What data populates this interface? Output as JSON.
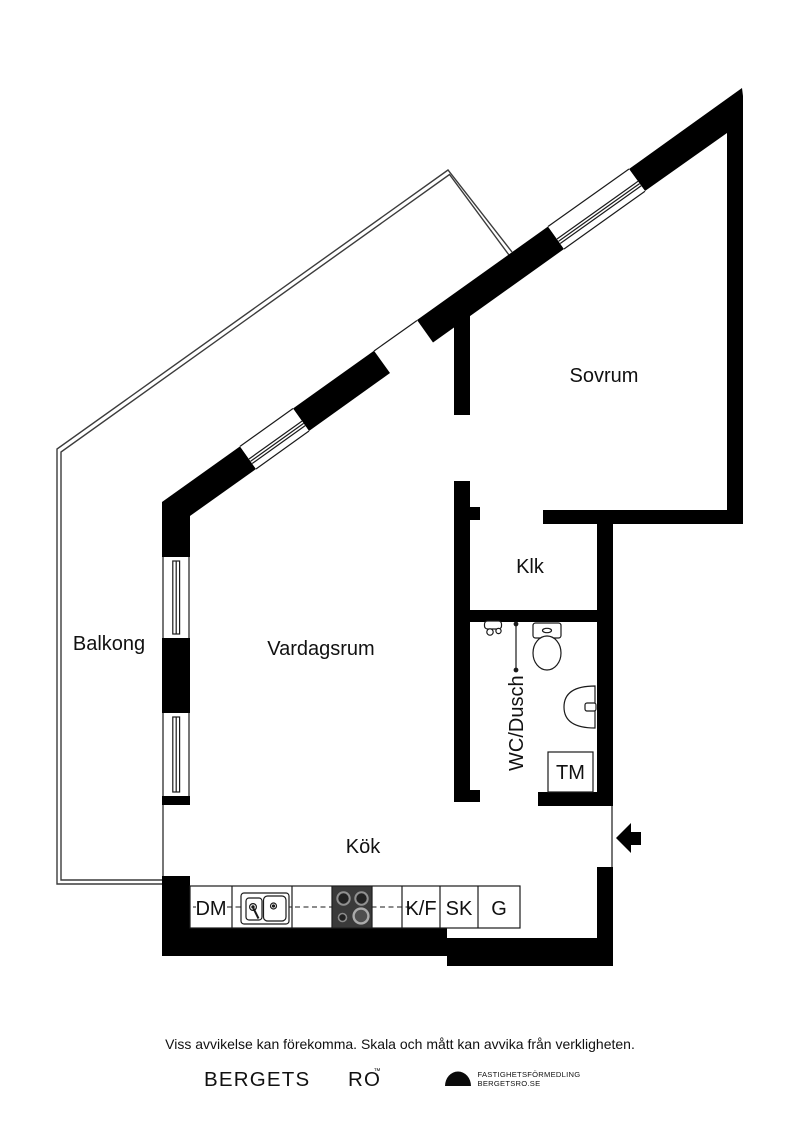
{
  "plan": {
    "rooms": {
      "sovrum": "Sovrum",
      "klk": "Klk",
      "vardagsrum": "Vardagsrum",
      "balkong": "Balkong",
      "kok": "Kök",
      "wc_dusch": "WC/Dusch",
      "tm": "TM"
    },
    "kitchen_units": {
      "dm": "DM",
      "kf": "K/F",
      "sk": "SK",
      "g": "G"
    },
    "colors": {
      "wall": "#000000",
      "stove": "#3a3a3a",
      "railing": "#3c3c3c",
      "text": "#111111"
    }
  },
  "footer": {
    "disclaimer": "Viss avvikelse kan förekomma. Skala och mått kan avvika från verkligheten.",
    "brand": {
      "word_1": "BERGETS",
      "word_2": "RO",
      "trademark": "™",
      "line_1": "FASTIGHETSFÖRMEDLING",
      "line_2": "BERGETSRO.SE"
    }
  }
}
